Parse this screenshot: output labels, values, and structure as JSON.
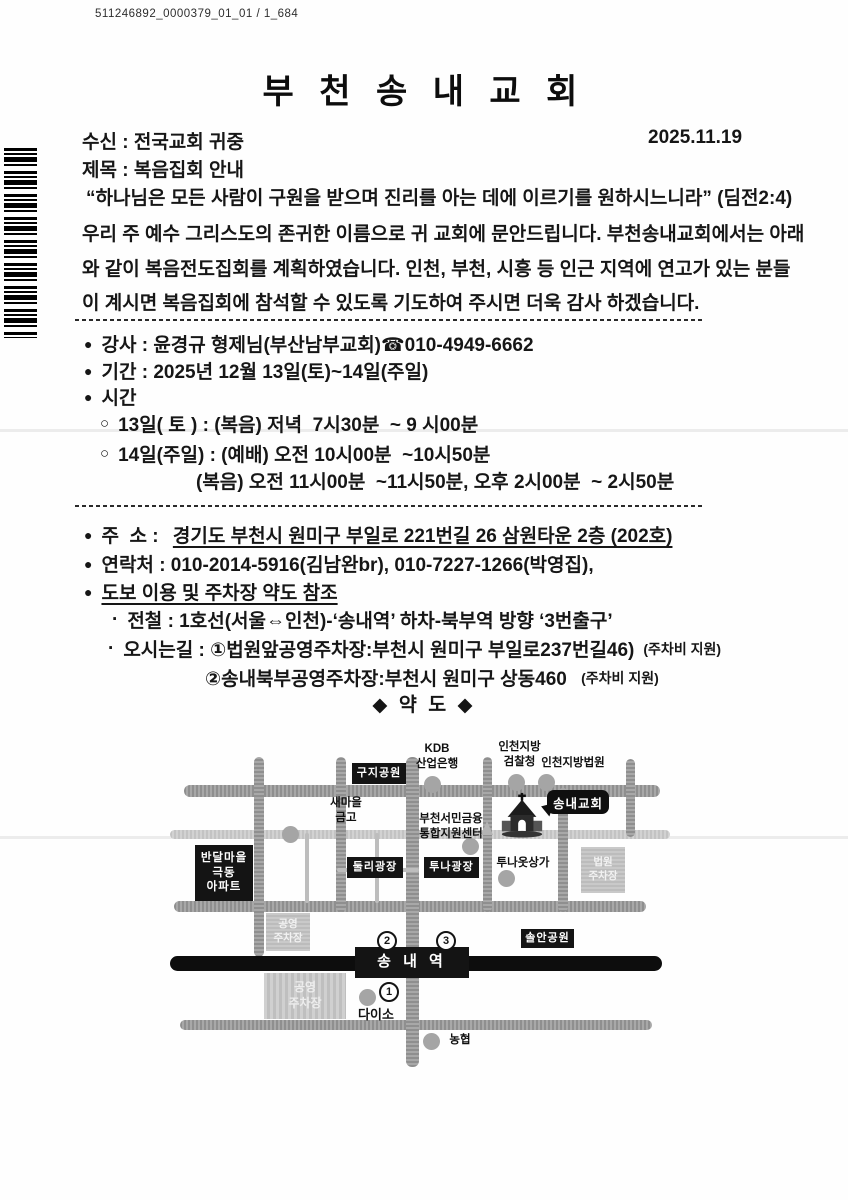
{
  "bullets": {
    "filled": "●",
    "open": "○",
    "dot": "·"
  },
  "scan": {
    "header_code": "511246892_0000379_01_01 / 1_684"
  },
  "title": "부 천 송 내 교 회",
  "meta": {
    "recipient": "수신 : 전국교회 귀중",
    "date": "2025.11.19",
    "subject": "제목 : 복음집회 안내"
  },
  "intro": {
    "lines": [
      "“하나님은 모든 사람이 구원을 받으며 진리를 아는 데에 이르기를 원하시느니라” (딤전2:4)",
      "우리 주 예수 그리스도의 존귀한 이름으로 귀 교회에 문안드립니다. 부천송내교회에서는 아래",
      "와 같이 복음전도집회를 계획하였습니다. 인천, 부천, 시흥 등 인근 지역에 연고가 있는 분들",
      "이 계시면 복음집회에 참석할 수 있도록 기도하여 주시면 더욱 감사 하겠습니다."
    ]
  },
  "details": {
    "speaker": "강사 : 윤경규 형제님(부산남부교회)☎010-4949-6662",
    "period": "기간 : 2025년 12월 13일(토)~14일(주일)",
    "time_label": "시간",
    "time1": "13일( 토 ) : (복음) 저녁  7시30분  ~ 9 시00분",
    "time2": "14일(주일) : (예배) 오전 10시00분  ~10시50분",
    "time2b": "(복음) 오전 11시00분  ~11시50분, 오후 2시00분  ~ 2시50분"
  },
  "address": {
    "addr_label": "주  소 : ",
    "addr_value": "경기도 부천시 원미구 부일로 221번길 26 삼원타운 2층 (202호)",
    "contact": "연락처 : 010-2014-5916(김남완br), 010-7227-1266(박영집),",
    "walk_note": "도보 이용 및 주차장 약도 참조",
    "subway": "전철 : 1호선(서울⇔인천)-‘송내역’ 하차-북부역 방향 ‘3번출구’",
    "direction1": "오시는길 : ①법원앞공영주차장:부천시 원미구 부일로237번길46)",
    "direction1_note": "(주차비 지원)",
    "direction2": "②송내북부공영주차장:부천시 원미구 상동460 ",
    "direction2_note": "(주차비 지원)"
  },
  "map": {
    "heading": "◆ 약 도 ◆",
    "labels": {
      "kdb": "KDB\n산업은행",
      "prosecutor": "인천지방\n검찰청",
      "district_court": "인천지방법원",
      "guji_park": "구지공원",
      "church_callout": "송내교회",
      "saemaul": "새마을\n금고",
      "finance_center": "부천서민금융\n통합지원센터",
      "bandal_apt": "반달마을\n극동\n아파트",
      "dooly_plaza": "둘리광장",
      "tuna_plaza": "투나광장",
      "tuna_mall": "투나옷상가",
      "court_parking": "법원\n주차장",
      "public_parking_nw": "공영\n주차장",
      "public_parking_sw": "공영\n주차장",
      "solan_park": "솔안공원",
      "station": "송 내 역",
      "exit1": "1",
      "exit2": "2",
      "exit3": "3",
      "daiso": "다이소",
      "nonghyup": "농협"
    }
  },
  "colors": {
    "ink": "#111111",
    "road": "#9e9e9e",
    "road_light": "#c7c7c7",
    "box_black": "#141414",
    "parking": "#c4c4c4",
    "circle": "#a5a5a5"
  }
}
